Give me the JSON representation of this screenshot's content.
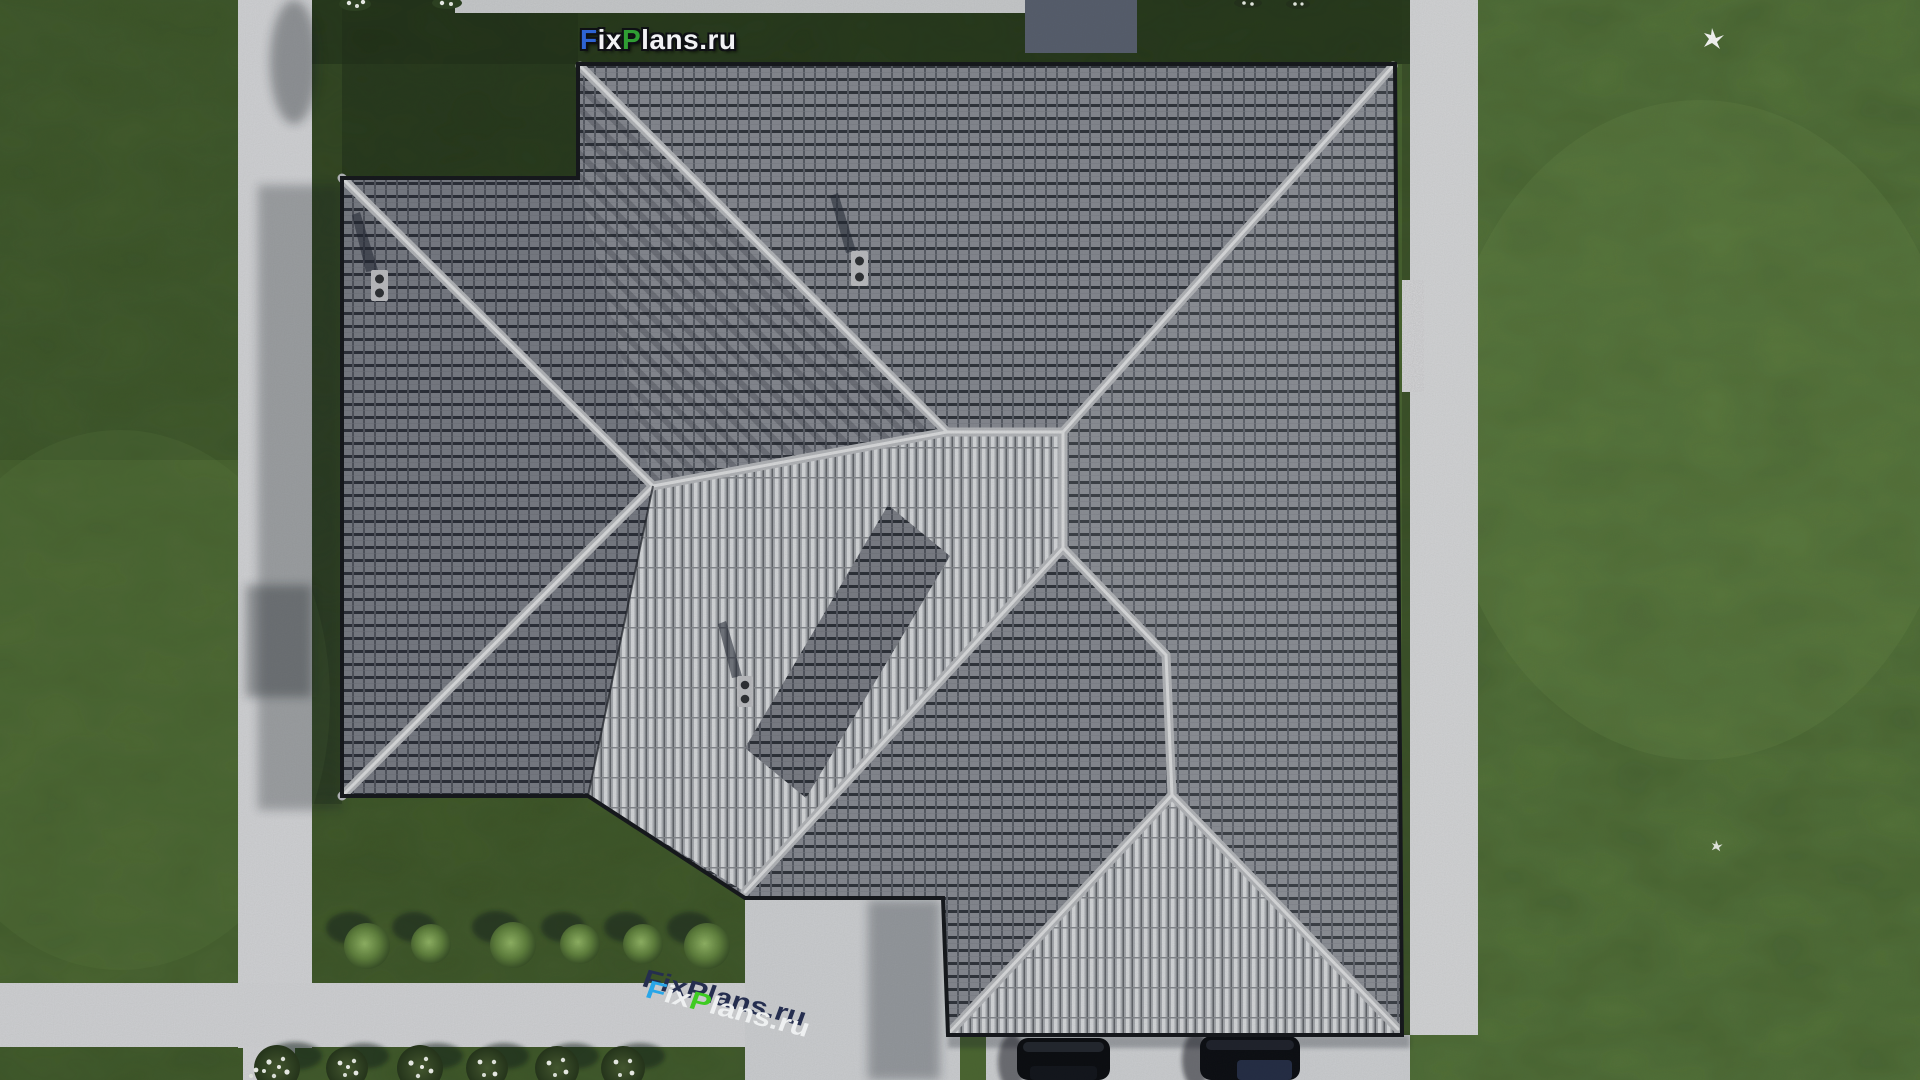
{
  "site": {
    "description": "Aerial top-down 3D render of a single-storey house with grey hip roof, lawn, concrete walkways, shrubs and two parked cars",
    "brand": "FixPlans.ru"
  },
  "watermark_top": {
    "text": "FixPlans.ru",
    "segments": {
      "f": "F",
      "ix": "ix",
      "p": "P",
      "lans": "lans",
      "dotru": ".ru"
    },
    "colors": {
      "f": "#2e64d3",
      "p": "#2f9e33",
      "rest": "#f1f2f4"
    }
  },
  "watermark_ground": {
    "text": "FixPlans.ru",
    "segments": {
      "f": "F",
      "ix": "ix",
      "p": "P",
      "lans": "lans",
      "dotru": ".ru"
    },
    "colors": {
      "f": "#29a6e8",
      "p": "#3ecb22",
      "rest": "#eef0f1",
      "shadow": "#252e4f"
    },
    "rotation_deg": 14
  },
  "scene": {
    "roof": {
      "tile_color": "#84878f",
      "rib_color": "#d3d5d8",
      "ridge_color": "#b1b3b7",
      "chimneys": 3,
      "sections": [
        "left-wing-hip",
        "main-top-slope",
        "right-slope",
        "central-ribbed-valley",
        "bottom-ribbed-hip"
      ]
    },
    "ground": {
      "grass_color": "#4e6a33",
      "dark_grass_color": "#1f2d17",
      "path_color": "#d0d1d4",
      "driveway_color": "#cbcdd0"
    },
    "vegetation": {
      "round_bushes": 6,
      "white_flower_bushes": 7,
      "top_edge_flower_clusters": 2
    },
    "objects": {
      "cars": 2,
      "car_color": "#0a0c10",
      "birds": 2,
      "bird_color": "#ffffff",
      "shed_roof_color": "#565d6c",
      "gravel_strip_color": "#dcdcde"
    }
  }
}
